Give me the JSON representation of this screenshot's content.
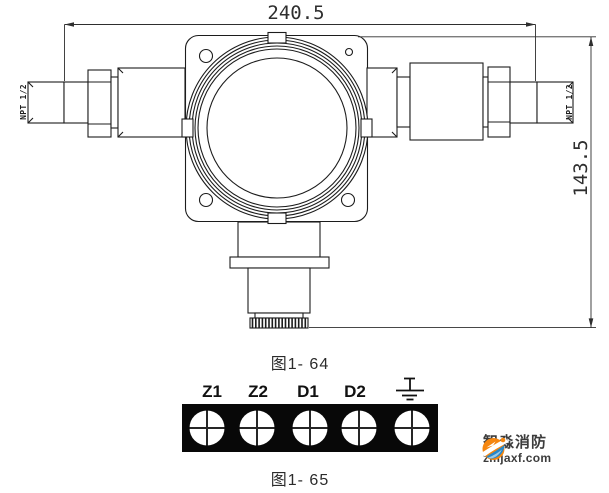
{
  "figure_device": {
    "caption": "图1- 64",
    "dim_width": "240.5",
    "dim_height": "143.5",
    "thread_left": "NPT 1/2",
    "thread_right": "NPT 1/2"
  },
  "figure_terminals": {
    "caption": "图1- 65",
    "labels": [
      "Z1",
      "Z2",
      "D1",
      "D2"
    ],
    "ground_icon": "earth-ground-symbol"
  },
  "watermark": {
    "brand": "智淼消防",
    "site": "zmjaxf.com",
    "orange": "#f5860f",
    "blue": "#2787c9",
    "text_color": "#3c3c3c"
  },
  "style": {
    "line_color": "#1c1c1c",
    "dimension_color": "#2e2e2e",
    "terminal_block_color": "#080808",
    "background": "#ffffff"
  }
}
